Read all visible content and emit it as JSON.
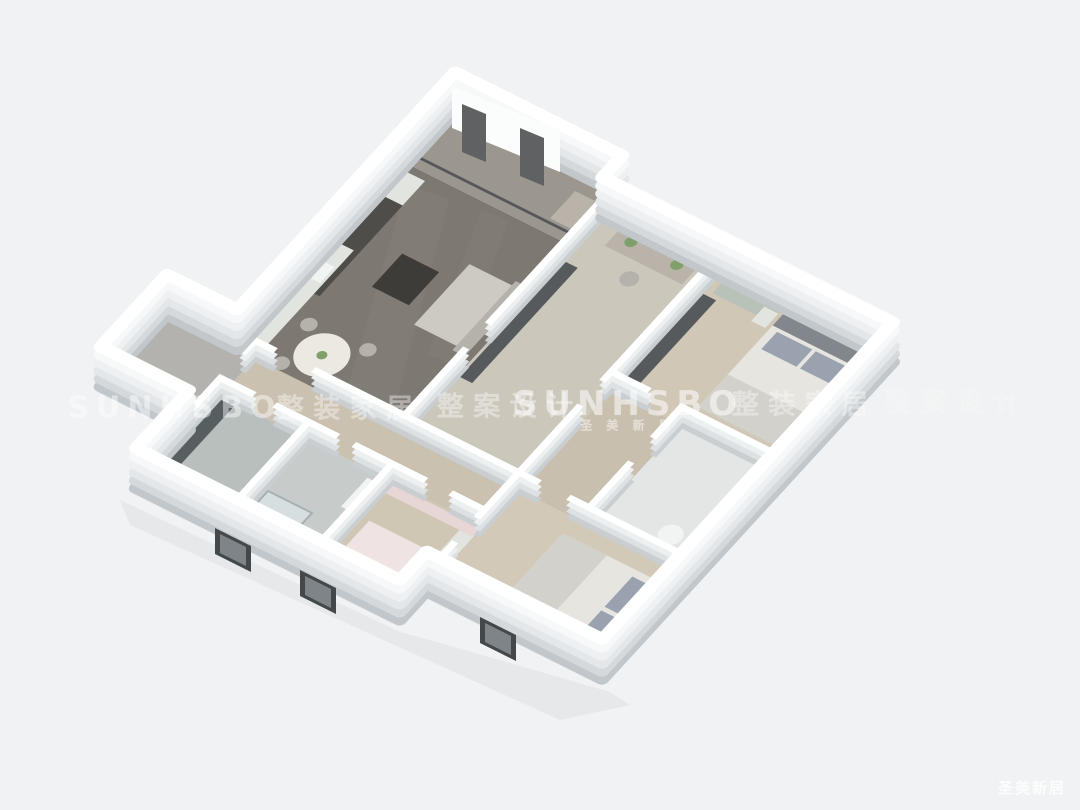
{
  "scene": {
    "description": "3D isometric rendering of an apartment floor plan on a light gray background",
    "background": "#f1f2f3"
  },
  "watermarks": {
    "row": [
      {
        "text": "SUNHSBO"
      },
      {
        "text": "整 装 家 居"
      },
      {
        "text": "整 案 设 计"
      },
      {
        "text": "SUNHSBO"
      },
      {
        "text": "圣 美 新 居"
      },
      {
        "text": "整 装 家 居"
      },
      {
        "text": "整 案 设 计"
      }
    ],
    "corner": {
      "text": "圣美新居"
    }
  },
  "palette": {
    "wall_top": "#ffffff",
    "inner1": "#c9ced1",
    "inner2": "#dde1e3",
    "inner3": "#edf0f1",
    "outer1": "#c2c7cb",
    "outer2": "#d5d9dc",
    "outer3": "#e3e7e9",
    "outer4": "#eef0f2",
    "outer5": "#f6f8f9",
    "glass_frame": "#54585b",
    "window_dark": "#44484b",
    "window_pane": "#7e8488",
    "curtain_panel": "#5f6163",
    "back_wall": "#fbfcfc",
    "shadow": "#c9ccd0"
  },
  "rooms": {
    "living_dining": {
      "floor": "#7d7871"
    },
    "marble_streak": {
      "floor": "#948f87"
    },
    "balcony_study": {
      "floor": "#9b978f"
    },
    "study": {
      "floor": "#ccc7bb"
    },
    "master_bedroom": {
      "floor": "#d1c7b6"
    },
    "master_bath": {
      "floor": "#e3e6e4"
    },
    "hallway": {
      "floor": "#c9bfae"
    },
    "south_bedroom": {
      "floor": "#d3c9b8"
    },
    "corridor": {
      "floor": "#cbc1b0"
    },
    "entry": {
      "floor": "#b4b2ae"
    },
    "bath_dark": {
      "floor": "#b9bfbd"
    },
    "bath_shower": {
      "floor": "#c7ccca"
    },
    "kids_bedroom": {
      "floor": "#d0c6b4"
    }
  },
  "furniture": {
    "cabinet_dark": "#4f4d4a",
    "cabinet_light": "#e2e4df",
    "sofa": "#cdcac4",
    "coffee_table": "#3e3c39",
    "dining_table": "#ece9e3",
    "chair": "#b5b2ac",
    "bed_white": "#e7e5e0",
    "blanket": "#d3d1cb",
    "pillow_blue": "#9aa2b0",
    "pillow_pink": "#e3bfc4",
    "pink_blanket": "#efe3e3",
    "headboard": "#82878d",
    "wardrobe_sage": "#b9c2b8",
    "wardrobe_dark": "#565a5c",
    "feature_wall": "#575e60",
    "shower_glass": "#dce4e6",
    "pink_wall": "#e8d6d6",
    "plant": "#7fa06a",
    "desk": "#b9b3aa",
    "fixture_white": "#f2f4f4"
  }
}
